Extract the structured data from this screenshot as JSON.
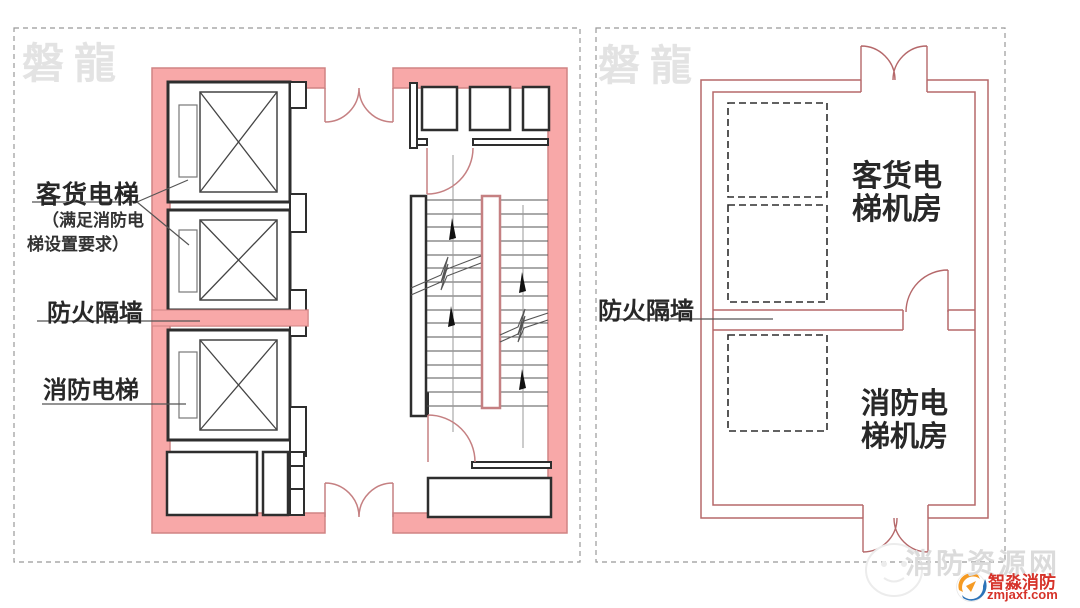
{
  "colors": {
    "wall_fill": "#F8A8A8",
    "wall_stroke": "#D08484",
    "thin_wall_red": "#B5686A",
    "door_arc": "#C58082",
    "black_line": "#2E2E2E",
    "label_text": "#282828",
    "watermark_gray": "#E3E3E3",
    "logo_red": "#D6332A"
  },
  "left_panel": {
    "watermark": "磐龍",
    "labels": {
      "freight_elevator": "客货电梯",
      "freight_note_line1": "（满足消防电",
      "freight_note_line2": "梯设置要求）",
      "fire_partition": "防火隔墙",
      "fire_elevator": "消防电梯"
    }
  },
  "right_panel": {
    "watermark": "磐龍",
    "labels": {
      "fire_partition": "防火隔墙",
      "freight_room_line1": "客货电",
      "freight_room_line2": "梯机房",
      "fire_room_line1": "消防电",
      "fire_room_line2": "梯机房"
    }
  },
  "footer": {
    "site_watermark": "消防资源网",
    "logo_name": "智淼消防",
    "logo_domain": "zmjaxf.com"
  }
}
